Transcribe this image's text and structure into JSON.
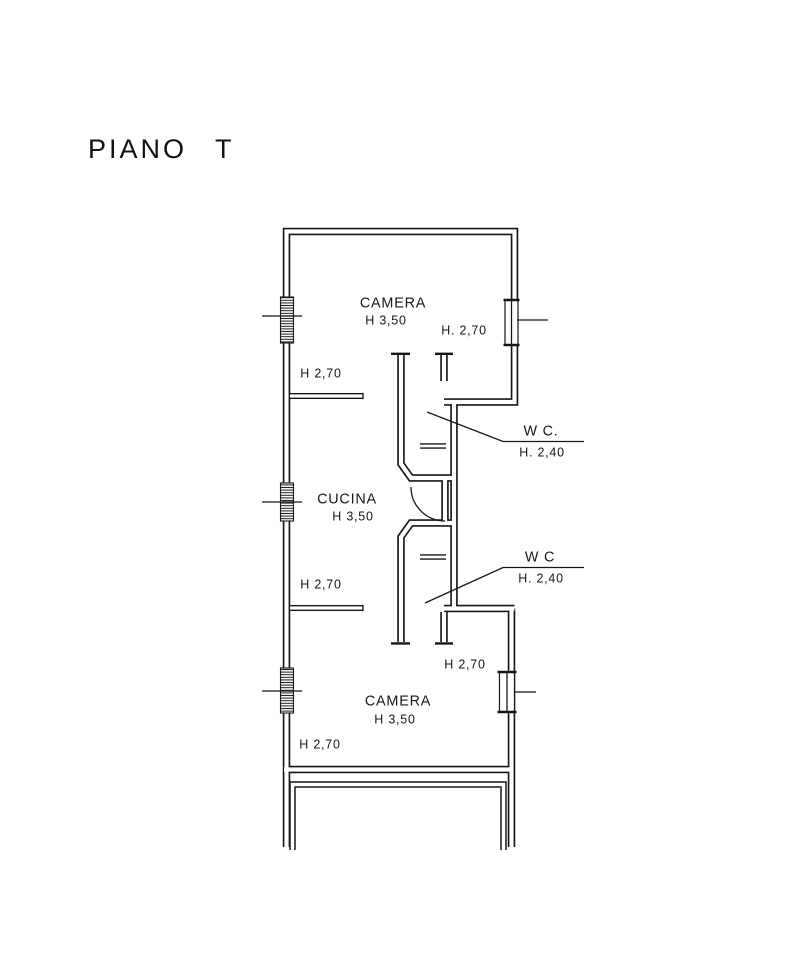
{
  "title": "PIANO T",
  "colors": {
    "ink": "#161616",
    "paper": "#ffffff"
  },
  "labels": {
    "camera_top": {
      "name": "CAMERA",
      "height": "H 3,50",
      "right_h": "H. 2,70",
      "left_h": "H 2,70"
    },
    "cucina": {
      "name": "CUCINA",
      "height": "H 3,50",
      "left_h": "H 2,70"
    },
    "wc_top": {
      "name": "W C.",
      "height": "H. 2,40"
    },
    "wc_bottom": {
      "name": "W C",
      "height": "H. 2,40"
    },
    "camera_bottom": {
      "name": "CAMERA",
      "height": "H 3,50",
      "right_h": "H 2,70",
      "left_h": "H 2,70"
    }
  }
}
